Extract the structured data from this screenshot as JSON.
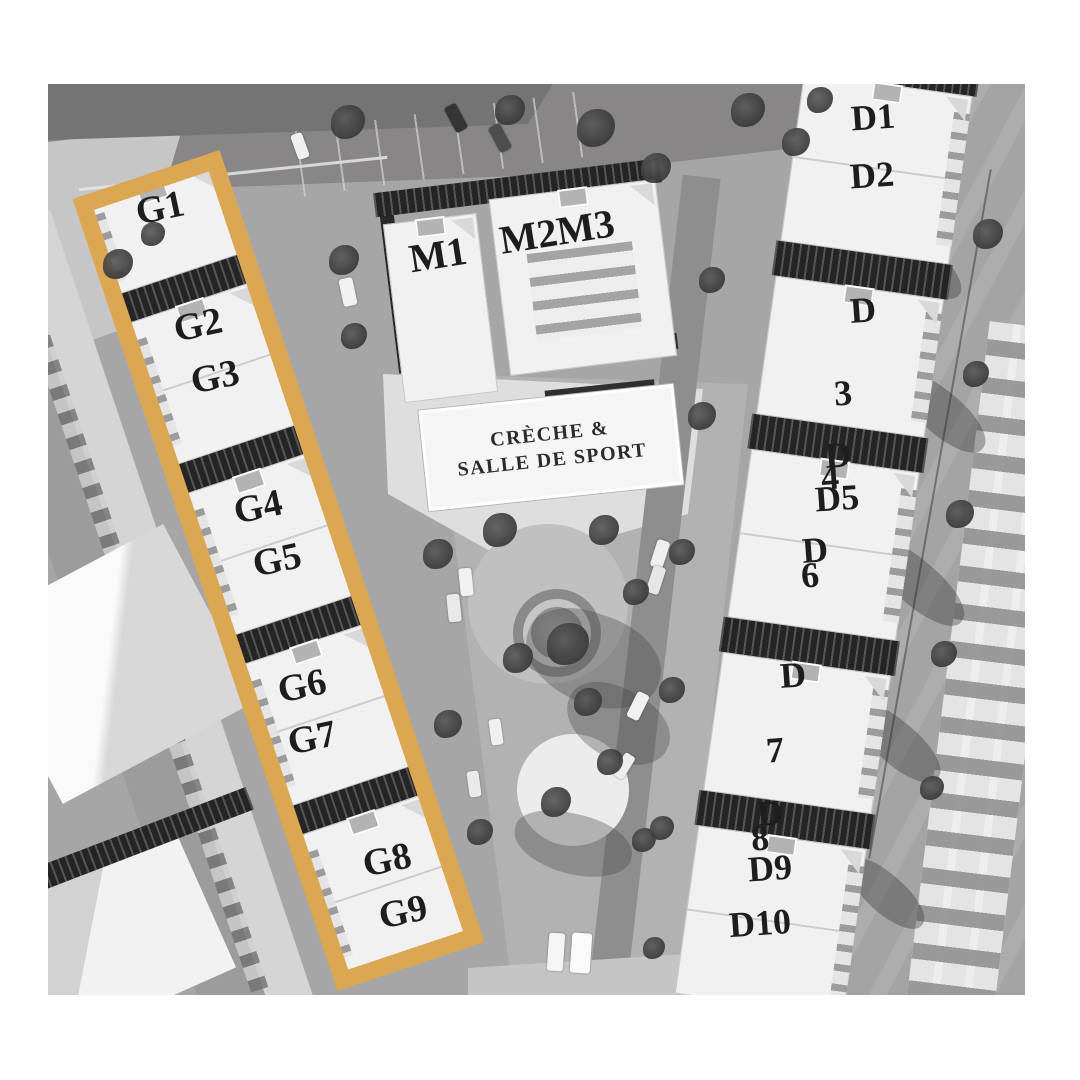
{
  "plan": {
    "highlight_color": "#DBA752",
    "g_row": [
      "G1",
      "G2",
      "G3",
      "G4",
      "G5",
      "G6",
      "G7",
      "G8",
      "G9"
    ],
    "m_row": [
      "M1",
      "M2M3"
    ],
    "amenity": {
      "line1": "CRÈCHE &",
      "line2": "SALLE DE SPORT"
    },
    "d_row": [
      {
        "unit": "D1",
        "lines": [
          "D1"
        ]
      },
      {
        "unit": "D2",
        "lines": [
          "D2"
        ]
      },
      {
        "unit": "D3",
        "lines": [
          "D",
          "3"
        ]
      },
      {
        "unit": "D4",
        "lines": [
          "D",
          "4"
        ]
      },
      {
        "unit": "D5",
        "lines": [
          "D5"
        ]
      },
      {
        "unit": "D6",
        "lines": [
          "D",
          "6"
        ]
      },
      {
        "unit": "D7",
        "lines": [
          "D",
          "7"
        ]
      },
      {
        "unit": "D8",
        "lines": [
          "D",
          "8"
        ]
      },
      {
        "unit": "D9",
        "lines": [
          "D9"
        ]
      },
      {
        "unit": "D10",
        "lines": [
          "D10"
        ]
      }
    ]
  }
}
